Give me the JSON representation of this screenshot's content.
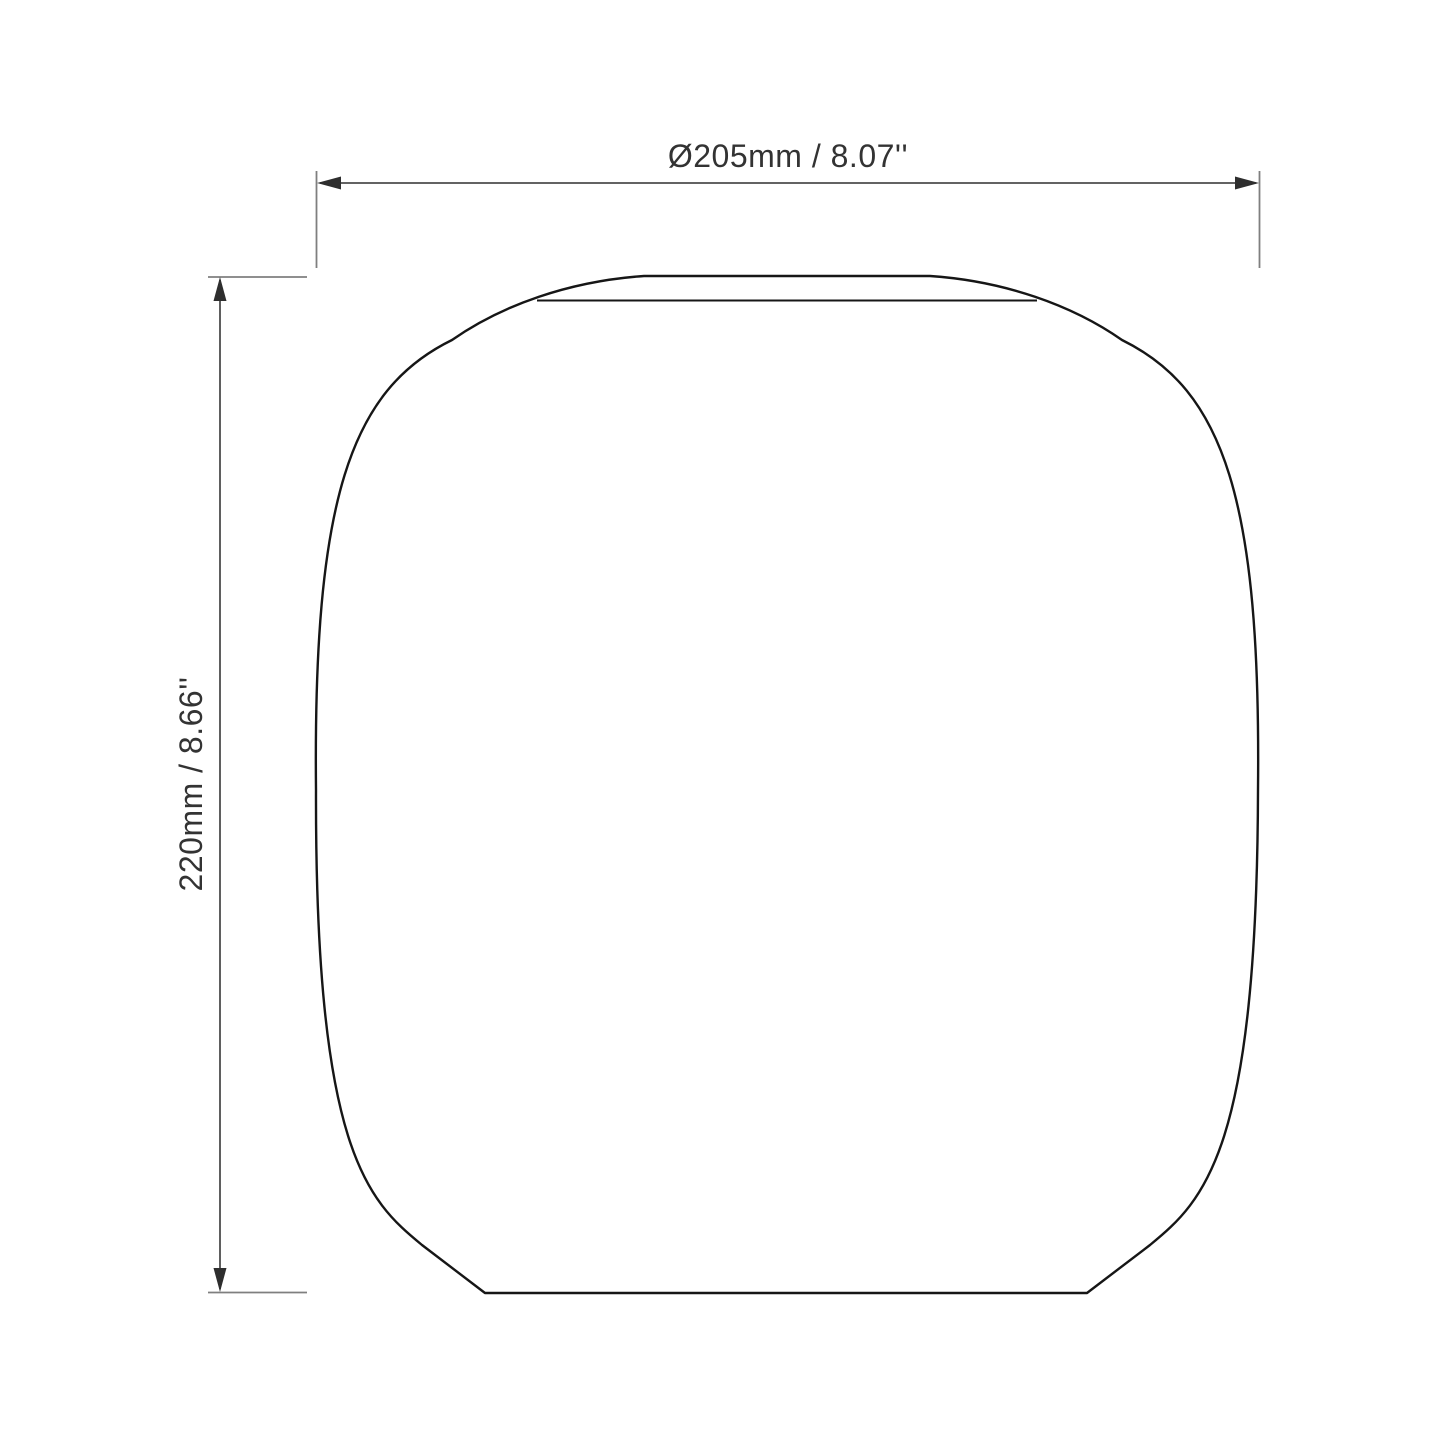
{
  "drawing": {
    "type": "technical-dimension-drawing",
    "dimension_labels": {
      "width": "Ø205mm / 8.07''",
      "height": "220mm / 8.66''"
    },
    "dimension_values": {
      "width_mm": 205,
      "width_in": 8.07,
      "height_mm": 220,
      "height_in": 8.66
    },
    "colors": {
      "background": "#ffffff",
      "outline": "#161616",
      "dimension_line": "#4d4d4d",
      "extension_line": "#7f7f7f",
      "arrow": "#2e2e2e",
      "text": "#333333"
    }
  }
}
